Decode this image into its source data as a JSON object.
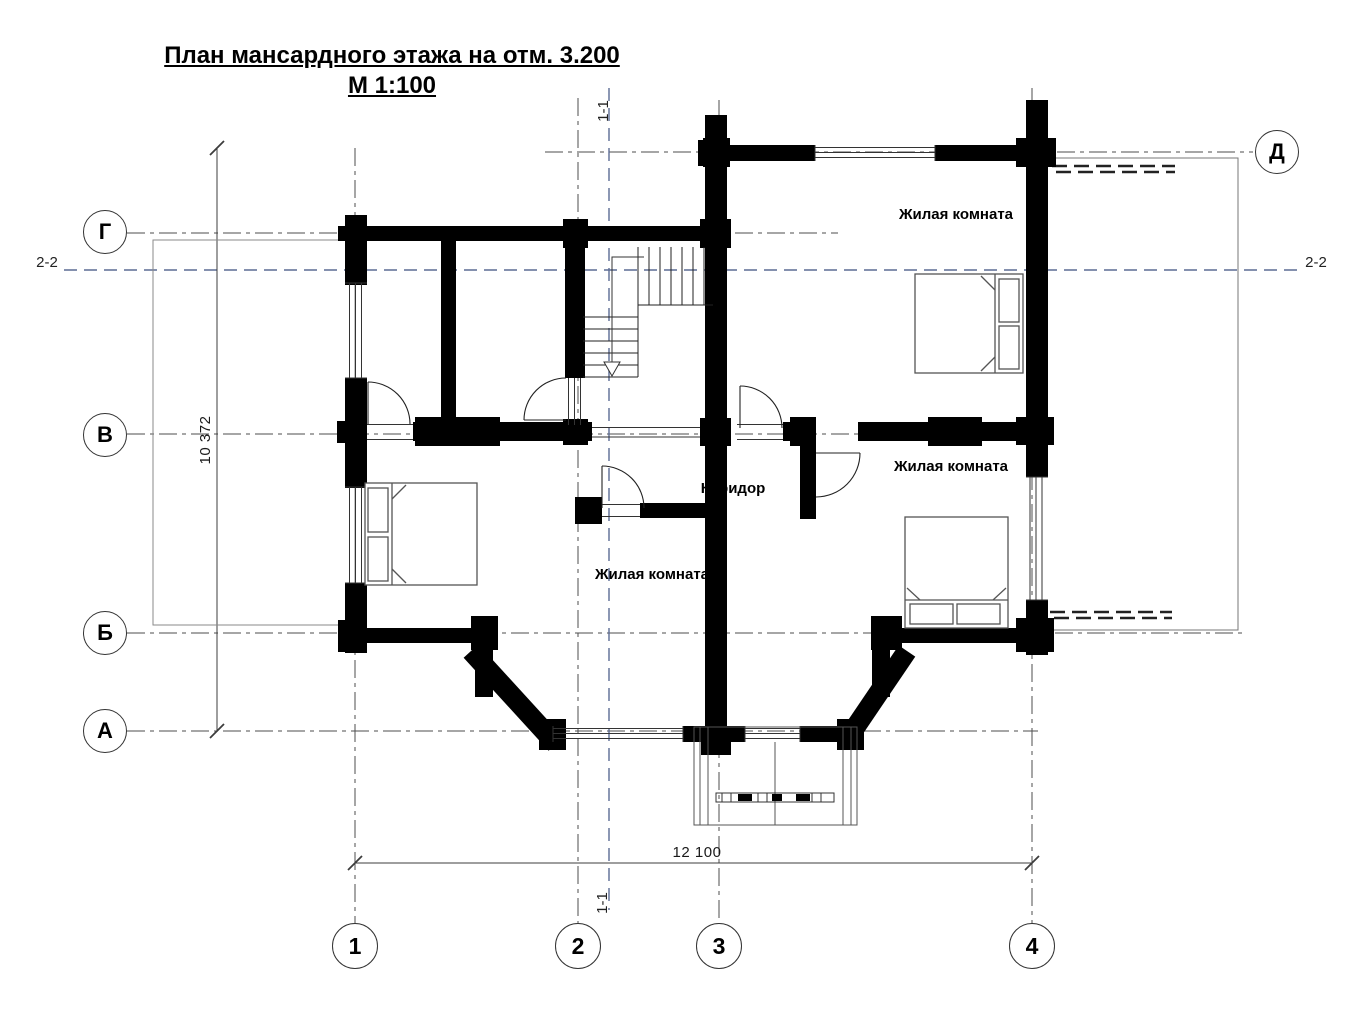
{
  "title": {
    "line1": "План мансардного этажа на отм. 3.200",
    "line2": "М 1:100"
  },
  "grid_axes": {
    "left": [
      {
        "label": "Г"
      },
      {
        "label": "В"
      },
      {
        "label": "Б"
      },
      {
        "label": "А"
      }
    ],
    "right": [
      {
        "label": "Д"
      }
    ],
    "bottom": [
      {
        "label": "1"
      },
      {
        "label": "2"
      },
      {
        "label": "3"
      },
      {
        "label": "4"
      }
    ]
  },
  "section_marks": {
    "vertical": "1-1",
    "horizontal": "2-2"
  },
  "dimensions": {
    "horizontal_total": "12 100",
    "vertical_total": "10 372"
  },
  "rooms": [
    {
      "name": "Жилая комната"
    },
    {
      "name": "Жилая комната"
    },
    {
      "name": "Жилая комната"
    },
    {
      "name": "Коридор"
    }
  ],
  "colors": {
    "wall": "#000000",
    "thin_line": "#3c3c3c",
    "grid_line": "#4d4d4d",
    "section_line": "#5b6b94",
    "background": "#ffffff"
  }
}
